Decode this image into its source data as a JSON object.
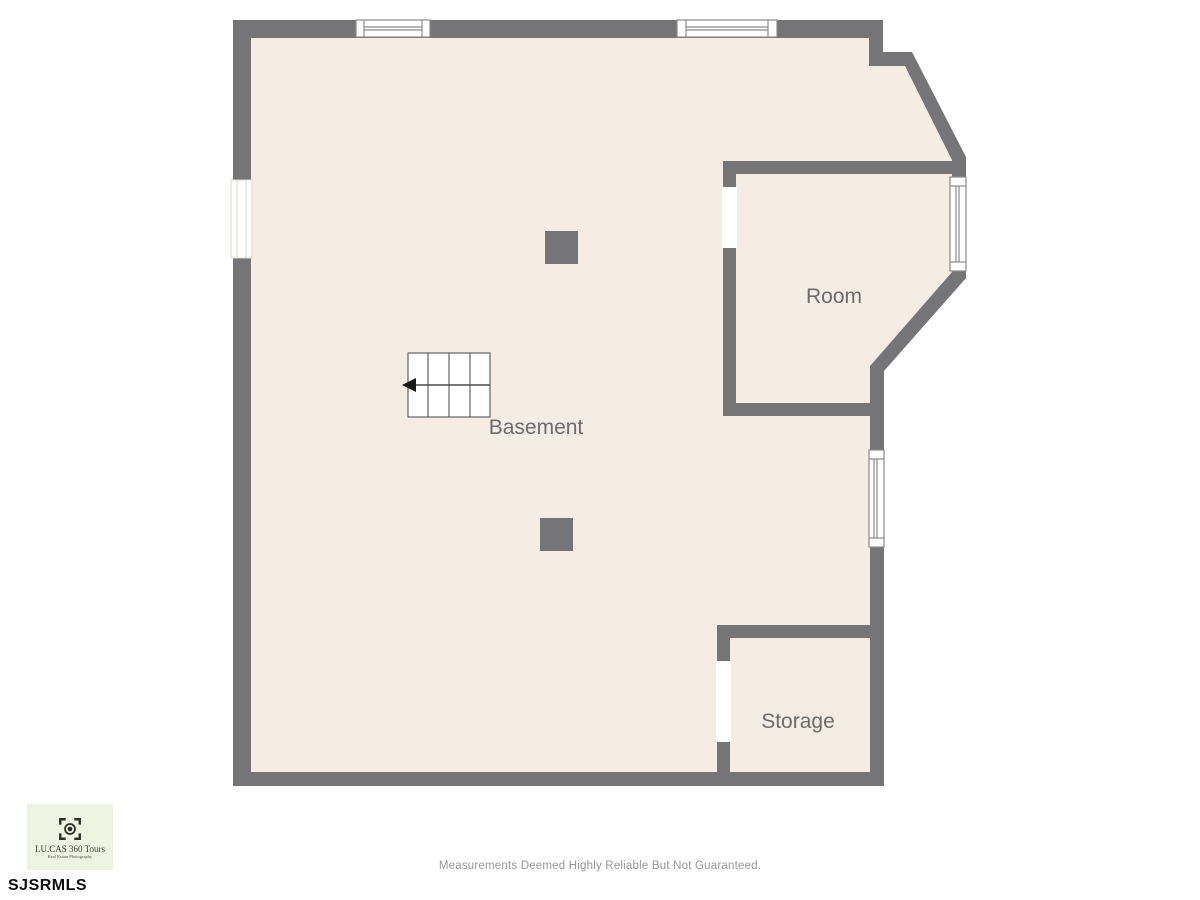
{
  "colors": {
    "wall": "#757578",
    "floor": "#f5ece4",
    "window": "#ffffff",
    "label": "#6f6b69",
    "disclaimer": "#97979b",
    "logo_bg": "#edf4e2",
    "logo_text": "#3c3c33",
    "mls": "#0f0f0f",
    "stair_arrow": "#1b1b1b"
  },
  "plan": {
    "labels": {
      "basement": "Basement",
      "room": "Room",
      "storage": "Storage"
    }
  },
  "footer": {
    "disclaimer": "Measurements Deemed Highly Reliable But Not Guaranteed.",
    "mls_id": "SJSRMLS"
  },
  "logo": {
    "title": "LU.CAS 360 Tours",
    "tagline": "Real Estate Photography",
    "icon": "camera-viewfinder-icon"
  }
}
